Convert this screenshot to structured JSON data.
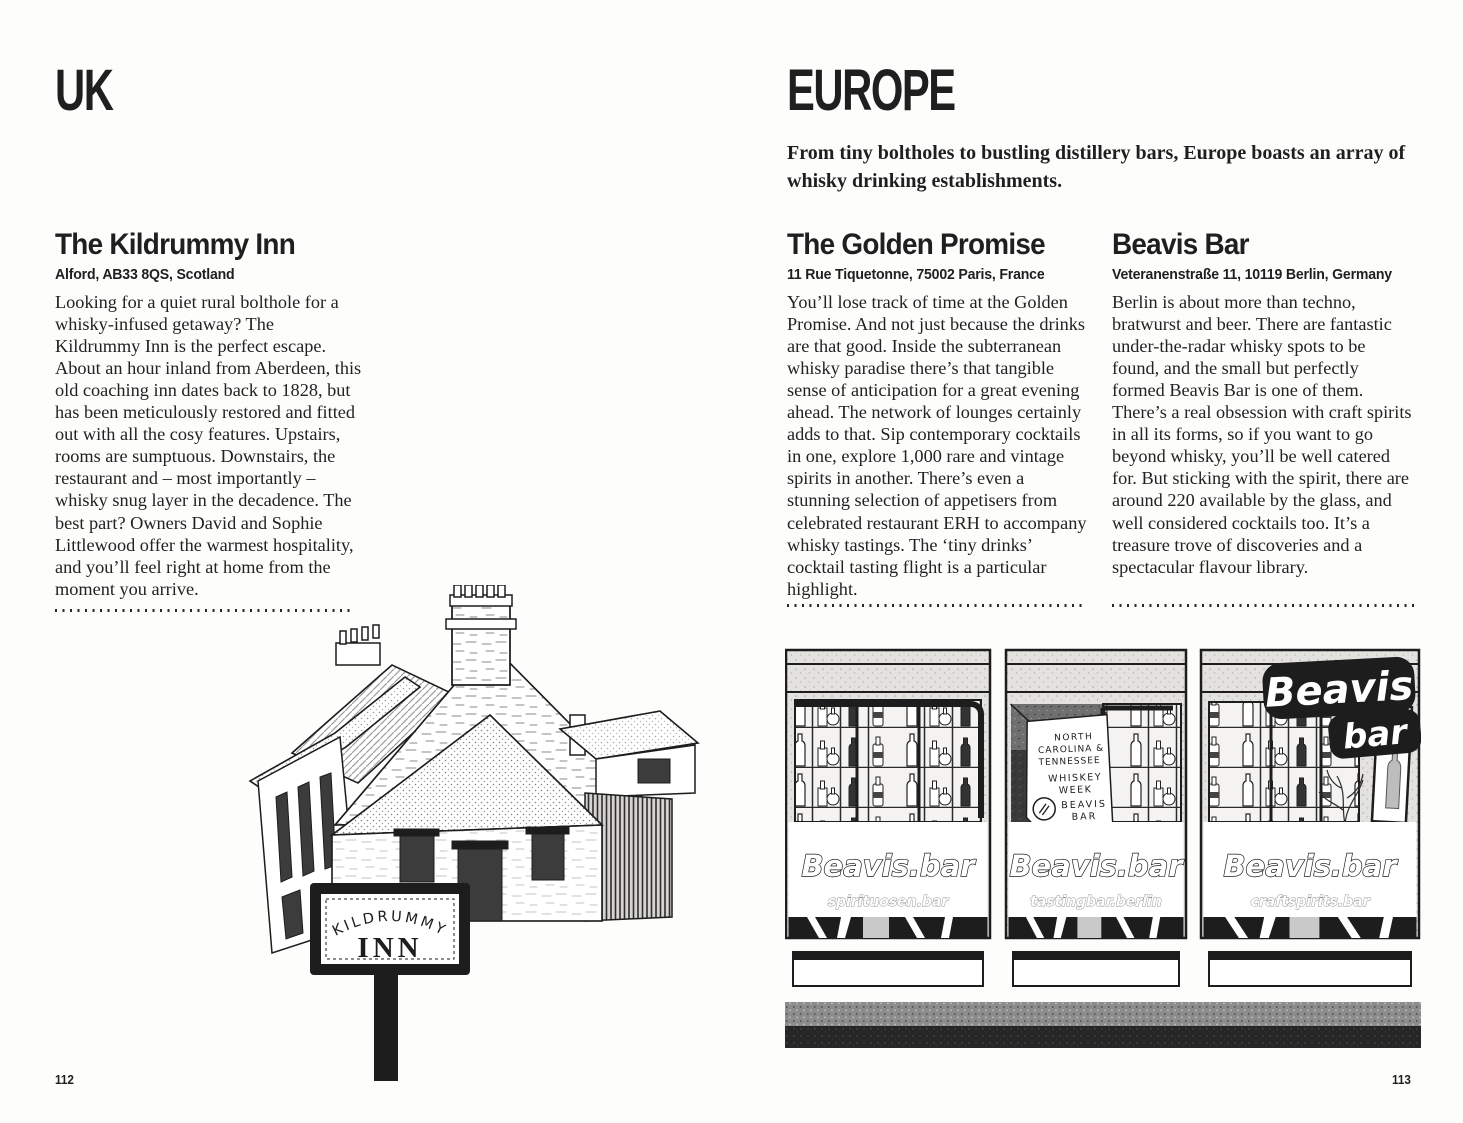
{
  "meta": {
    "ink_color": "#1d1d1d",
    "paper_color": "#ffffff"
  },
  "left_page": {
    "section_title": "UK",
    "article": {
      "title": "The Kildrummy Inn",
      "address": "Alford, AB33 8QS, Scotland",
      "body": "Looking for a quiet rural bolthole for a whisky-infused getaway? The Kildrummy Inn is the perfect escape. About an hour inland from Aberdeen, this old coaching inn dates back to 1828, but has been meticulously restored and fitted out with all the cosy features. Upstairs, rooms are sumptuous. Downstairs, the restaurant and – most importantly – whisky snug layer in the decadence. The best part? Owners David and Sophie Littlewood offer the warmest hospitality, and you’ll feel right at home from the moment you arrive."
    },
    "sign": {
      "line1": "KILDRUMMY",
      "line2": "INN"
    },
    "page_number": "112"
  },
  "right_page": {
    "section_title": "EUROPE",
    "intro": "From tiny boltholes to bustling distillery bars, Europe boasts an array of whisky drinking establishments.",
    "articles": [
      {
        "title": "The Golden Promise",
        "address": "11 Rue Tiquetonne, 75002 Paris, France",
        "body": "You’ll lose track of time at the Golden Promise. And not just because the drinks are that good. Inside the subterranean whisky paradise there’s that tangible sense of anticipation for a great evening ahead. The network of lounges certainly adds to that. Sip contemporary cocktails in one, explore 1,000 rare and vintage spirits in another. There’s even a stunning selection of appetisers from celebrated restaurant ERH to accompany whisky tastings. The ‘tiny drinks’ cocktail tasting flight is a particular highlight."
      },
      {
        "title": "Beavis Bar",
        "address": "Veteranenstraße 11, 10119 Berlin, Germany",
        "body": "Berlin is about more than techno, bratwurst and beer. There are fantastic under-the-radar whisky spots to be found, and the small but perfectly formed Beavis Bar is one of them. There’s a real obsession with craft spirits in all its forms, so if you want to go beyond whisky, you’ll be well catered for. But sticking with the spirit, there are around 220 available by the glass, and well considered cocktails too. It’s a treasure trove of discoveries and a spectacular flavour library."
      }
    ],
    "storefront": {
      "window_text": "Beavis.bar",
      "window_subtexts": [
        "spirituosen.bar",
        "tastingbar.berlin",
        "craftspirits.bar"
      ],
      "hanging_sign_lines": [
        "NORTH",
        "CAROLINA &",
        "TENNESSEE",
        "WHISKEY",
        "WEEK",
        "BEAVIS",
        "BAR"
      ],
      "graffiti": {
        "line1": "Beavis",
        "line2": "bar"
      }
    },
    "page_number": "113"
  }
}
